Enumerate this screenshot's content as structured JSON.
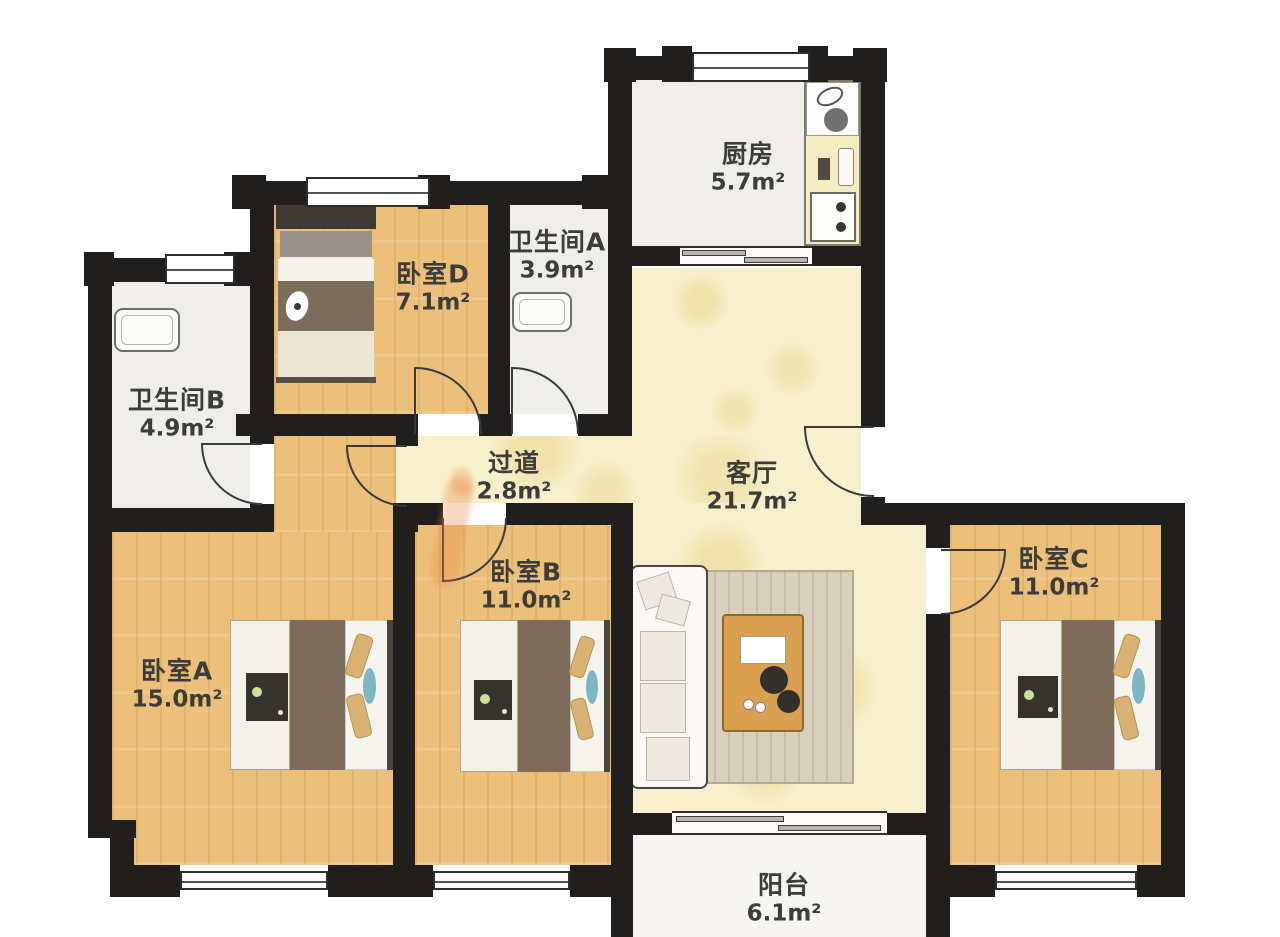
{
  "floorplan": {
    "unit": "m²",
    "rooms": [
      {
        "id": "kitchen",
        "name": "厨房",
        "area": "5.7m²"
      },
      {
        "id": "bathroom_a",
        "name": "卫生间A",
        "area": "3.9m²"
      },
      {
        "id": "bedroom_d",
        "name": "卧室D",
        "area": "7.1m²"
      },
      {
        "id": "bathroom_b",
        "name": "卫生间B",
        "area": "4.9m²"
      },
      {
        "id": "hallway",
        "name": "过道",
        "area": "2.8m²"
      },
      {
        "id": "living_room",
        "name": "客厅",
        "area": "21.7m²"
      },
      {
        "id": "bedroom_b",
        "name": "卧室B",
        "area": "11.0m²"
      },
      {
        "id": "bedroom_c",
        "name": "卧室C",
        "area": "11.0m²"
      },
      {
        "id": "bedroom_a",
        "name": "卧室A",
        "area": "15.0m²"
      },
      {
        "id": "balcony",
        "name": "阳台",
        "area": "6.1m²"
      }
    ],
    "colors": {
      "wall": "#201f1d",
      "wood_floor": "#ecc07a",
      "tile_floor": "#f8f0cc",
      "bath_floor": "#efeeeb",
      "balcony_floor": "#f6f5f1",
      "counter": "#f3edc0",
      "blanket_brown": "#7d6c59",
      "pillow_tan": "#d9b173",
      "accent_blue": "#7fb6c4",
      "rug": "#d9cfbd",
      "table_wood": "#d9a04f",
      "label_text": "#3d3c38",
      "watermark_orange": "#e8853f"
    }
  }
}
